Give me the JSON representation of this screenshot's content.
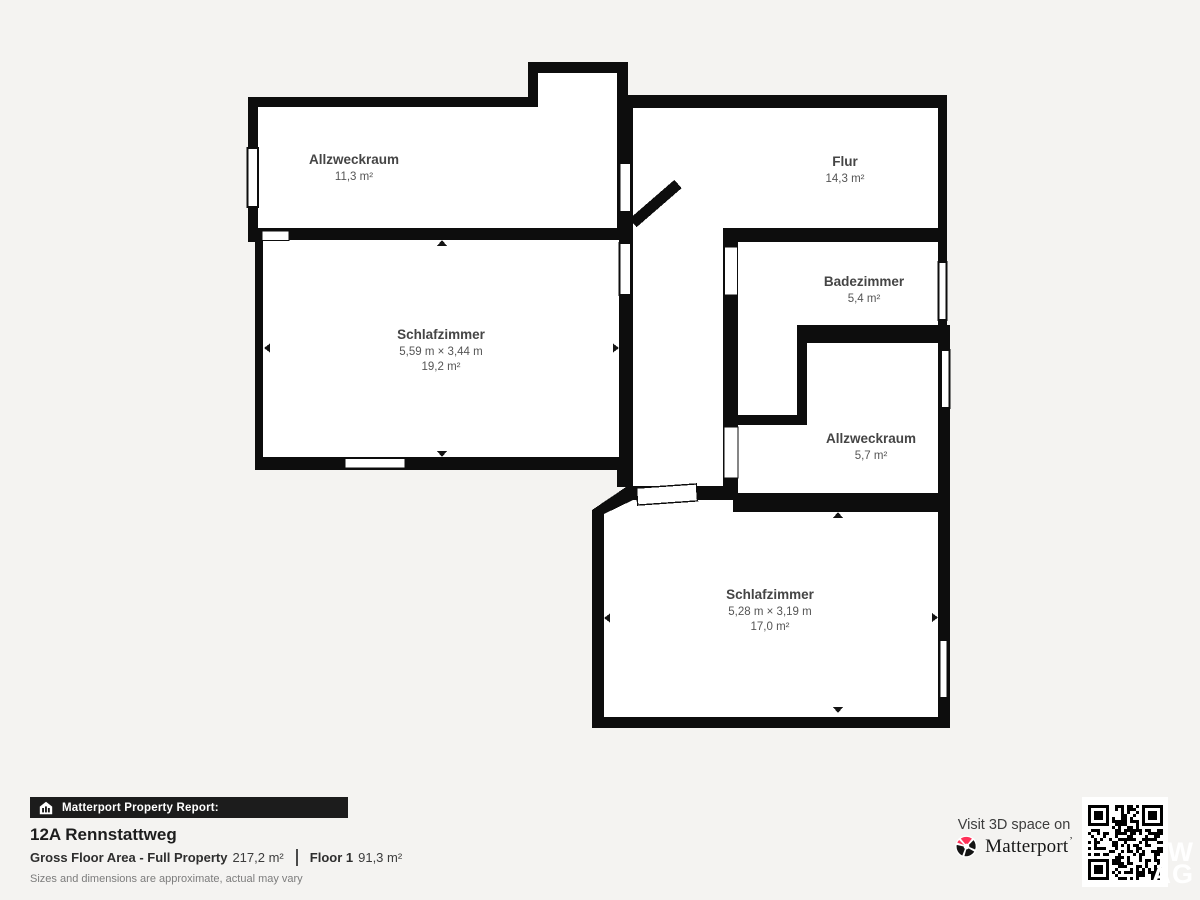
{
  "colors": {
    "background": "#f4f3f1",
    "wall": "#0d0d0d",
    "room_fill": "#ffffff",
    "label_text": "#454545",
    "sublabel_text": "#555555",
    "accent_red": "#ff3158",
    "footer_bar": "#1c1c1c"
  },
  "floorplan": {
    "rooms": [
      {
        "name": "Allzweckraum",
        "area": "11,3 m²"
      },
      {
        "name": "Flur",
        "area": "14,3 m²"
      },
      {
        "name": "Badezimmer",
        "area": "5,4 m²"
      },
      {
        "name": "Schlafzimmer",
        "dimensions": "5,59 m × 3,44 m",
        "area": "19,2 m²"
      },
      {
        "name": "Allzweckraum",
        "area": "5,7 m²"
      },
      {
        "name": "Schlafzimmer",
        "dimensions": "5,28 m × 3,19 m",
        "area": "17,0 m²"
      }
    ]
  },
  "footer": {
    "report_label": "Matterport Property Report:",
    "address": "12A Rennstattweg",
    "metrics": {
      "gross_label": "Gross Floor Area - Full Property",
      "gross_value": "217,2 m²",
      "floor_label": "Floor 1",
      "floor_value": "91,3 m²"
    },
    "disclaimer": "Sizes and dimensions are approximate, actual may vary",
    "visit_text": "Visit 3D space on",
    "brand": "Matterport",
    "brand_mark": "ʼ",
    "watermark": {
      "line1": "W",
      "line2": "AG"
    }
  }
}
